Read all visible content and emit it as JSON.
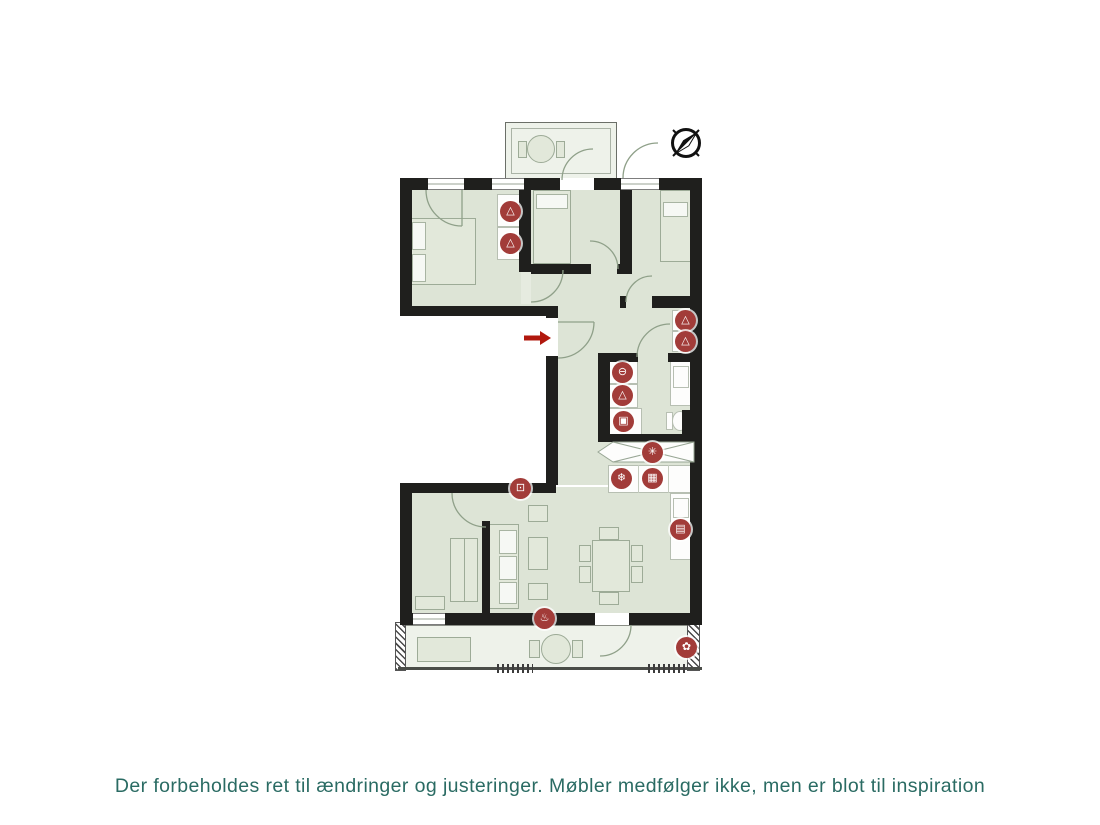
{
  "page": {
    "disclaimer": "Der forbeholdes ret til ændringer og justeringer. Møbler medfølger ikke, men er blot til inspiration"
  },
  "palette": {
    "wall": "#1f1f1d",
    "floor": "#dde4d6",
    "balcony_floor": "#eef2ea",
    "icon_red": "#a23c39",
    "arrow_red": "#b1180e",
    "text_teal": "#2a6b63",
    "furniture_line": "#9dab97"
  },
  "compass": {
    "needle_points": "NE"
  },
  "entrance_arrow": {
    "direction": "right"
  },
  "icons": [
    {
      "type": "wardrobe",
      "glyph": "△"
    },
    {
      "type": "wardrobe",
      "glyph": "△"
    },
    {
      "type": "wardrobe",
      "glyph": "△"
    },
    {
      "type": "wardrobe",
      "glyph": "△"
    },
    {
      "type": "washing-machine",
      "glyph": "⊖"
    },
    {
      "type": "wardrobe",
      "glyph": "△"
    },
    {
      "type": "dryer",
      "glyph": "▣"
    },
    {
      "type": "ventilation",
      "glyph": "✳"
    },
    {
      "type": "fridge",
      "glyph": "❄"
    },
    {
      "type": "oven",
      "glyph": "▦"
    },
    {
      "type": "appliance",
      "glyph": "▤"
    },
    {
      "type": "tv",
      "glyph": "⊡"
    },
    {
      "type": "heating",
      "glyph": "♨"
    },
    {
      "type": "outdoor-tap",
      "glyph": "✿"
    }
  ]
}
